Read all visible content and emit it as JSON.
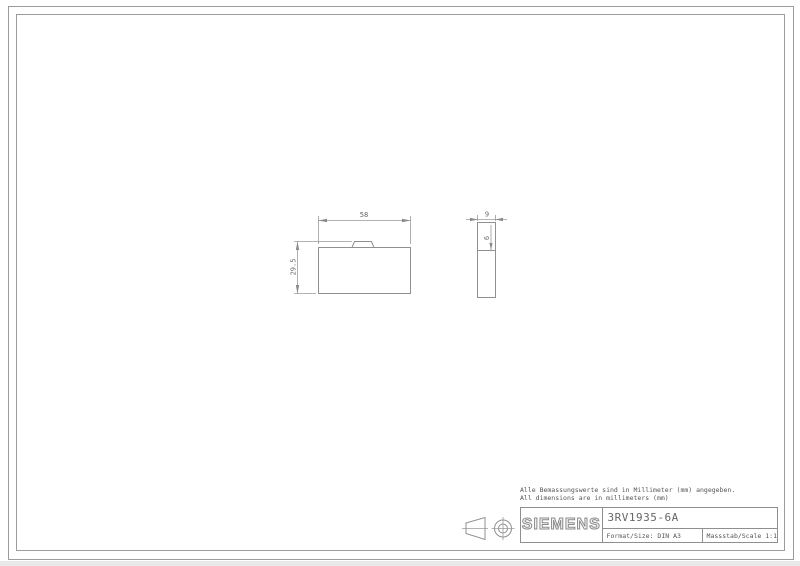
{
  "colors": {
    "background": "#ffffff",
    "line": "#909090",
    "frame": "#9c9c9c",
    "text": "#606060"
  },
  "notes": {
    "line1": "Alle Bemassungswerte sind in Millimeter (mm) angegeben.",
    "line2": "All dimensions are in millimeters (mm)"
  },
  "title_block": {
    "brand": "SIEMENS",
    "part_number": "3RV1935-6A",
    "format_label": "Format/Size: DIN A3",
    "scale_label": "Massstab/Scale 1:1"
  },
  "drawing": {
    "front_view": {
      "width_dim": "58",
      "height_dim": "29.5"
    },
    "side_view": {
      "width_dim": "9",
      "step_dim": "6"
    }
  },
  "icons": {
    "projection": "first-angle-projection"
  }
}
